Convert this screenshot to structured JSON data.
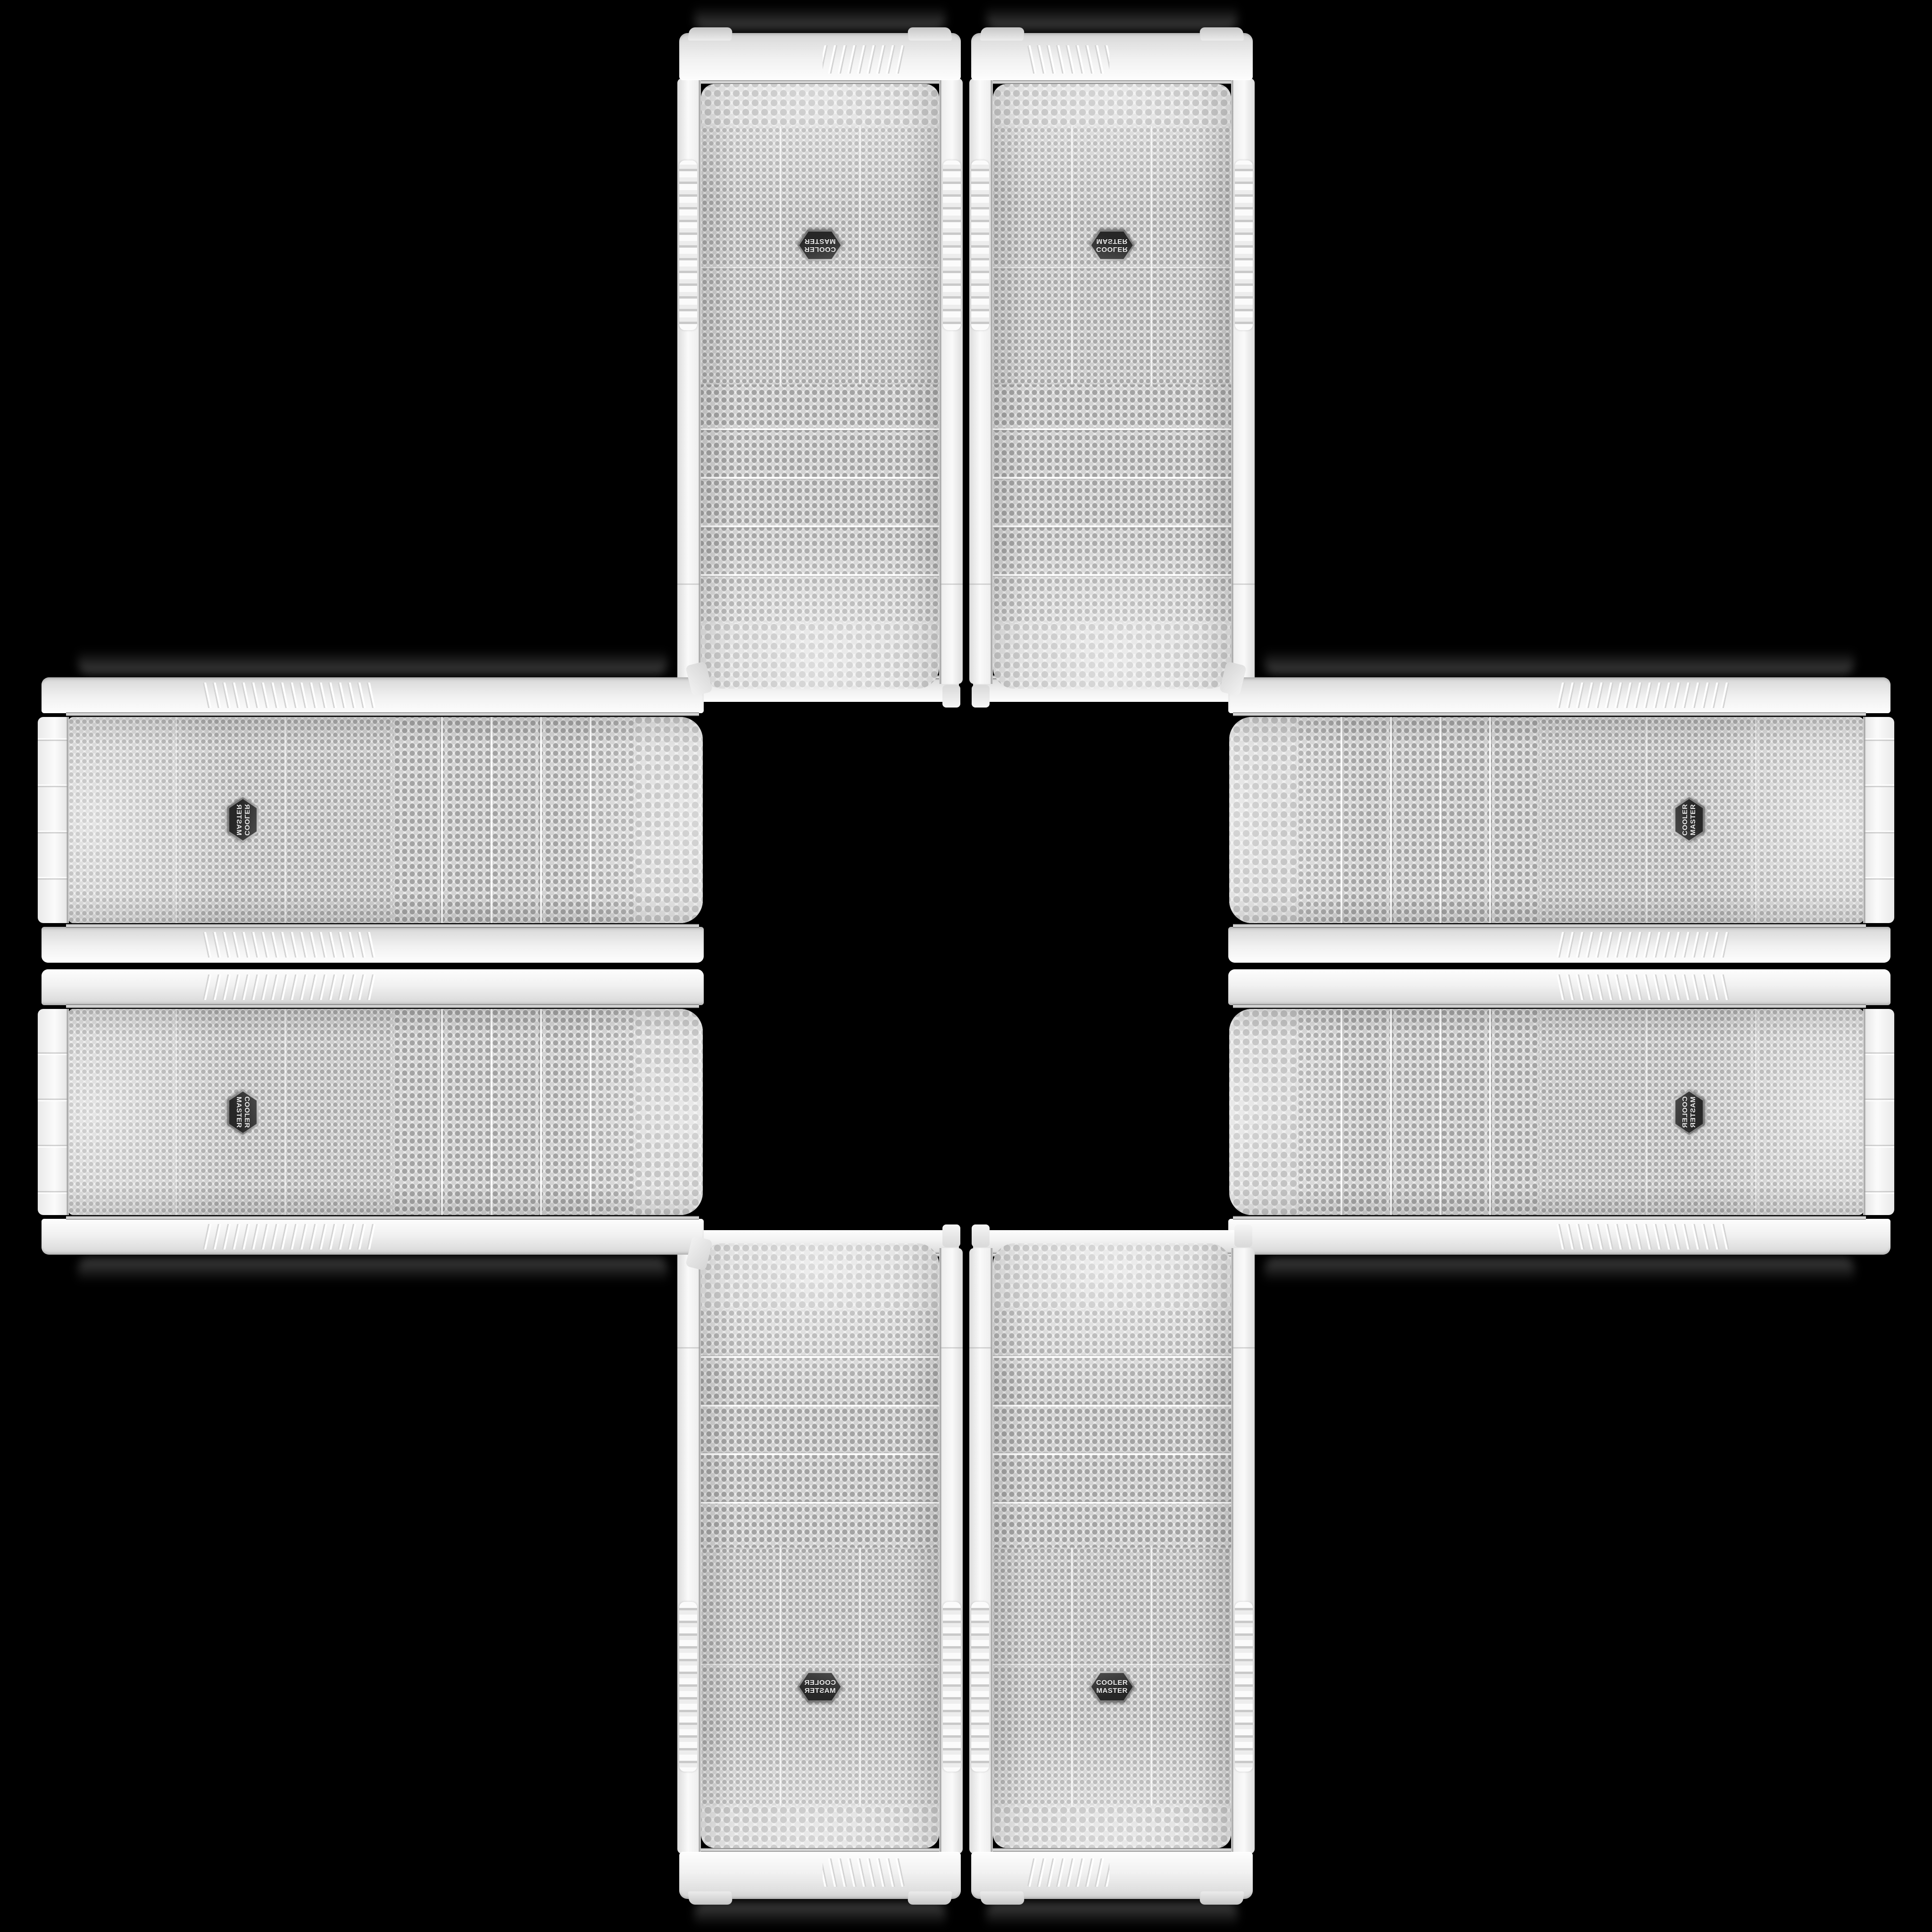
{
  "scene": {
    "background_color": "#000000",
    "layout": {
      "pattern": "plus-cross",
      "center_empty": true,
      "case_count": 8
    },
    "badge": {
      "line1": "COOLER",
      "line2": "MASTER"
    },
    "colors": {
      "background": "#000000",
      "case_white": "#f1f1f1",
      "cap_highlight": "#fdfdfd",
      "cap_shadow": "#cfcfcf",
      "mesh_base": "#eaeaea",
      "mesh_hole_dark": "#a9a9a9",
      "mesh_hole_light": "#d2d2d2",
      "chrome_light": "#f0f0f0",
      "chrome_dark": "#6e6e6e",
      "badge_background": "#2b2b2b",
      "badge_ring": "#a8a8a8",
      "badge_text": "#ececec"
    },
    "cases": [
      {
        "id": "case-top-left",
        "type": "vertical",
        "slot": "top-left"
      },
      {
        "id": "case-top-right",
        "type": "vertical",
        "slot": "top-right"
      },
      {
        "id": "case-left-top",
        "type": "horizontal",
        "slot": "left-top"
      },
      {
        "id": "case-left-bottom",
        "type": "horizontal",
        "slot": "left-bottom"
      },
      {
        "id": "case-right-top",
        "type": "horizontal",
        "slot": "right-top"
      },
      {
        "id": "case-right-bottom",
        "type": "horizontal",
        "slot": "right-bottom"
      },
      {
        "id": "case-bottom-left",
        "type": "vertical",
        "slot": "bottom-left"
      },
      {
        "id": "case-bottom-right",
        "type": "vertical",
        "slot": "bottom-right"
      }
    ]
  }
}
